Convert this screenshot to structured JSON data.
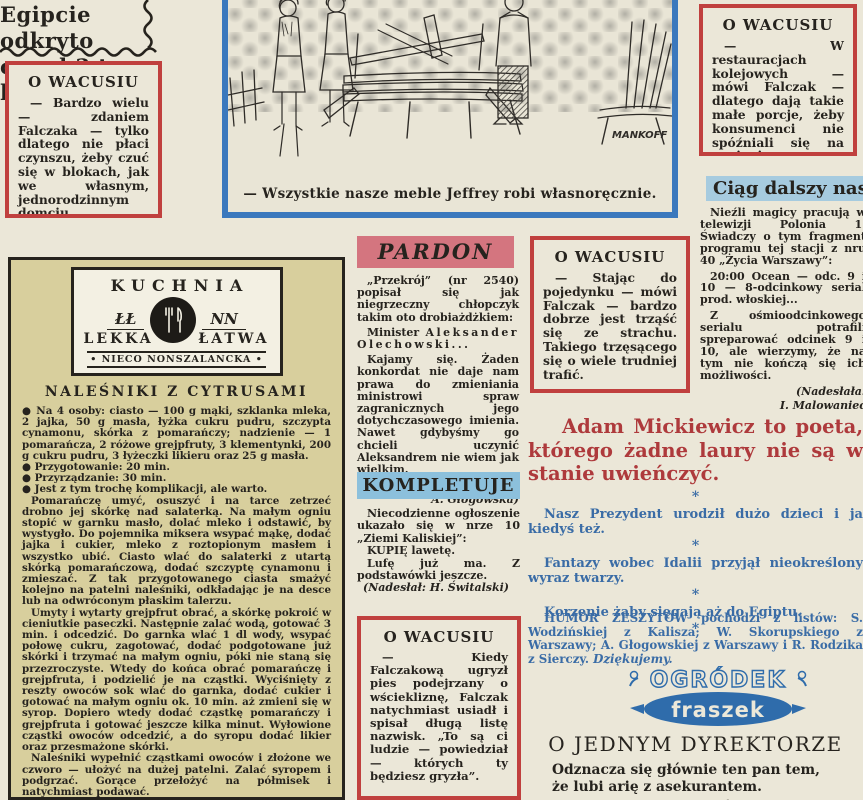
{
  "palette": {
    "paper": "#ebe7d8",
    "red_accent": "#c0403e",
    "red_heading": "#ae3a3c",
    "blue_border": "#3a78bd",
    "blue_strip": "#a6cbdf",
    "pink_strip": "#d4757f",
    "light_blue_strip": "#8cc0dc",
    "blue_text": "#3a6ca6",
    "yellow_box": "#d8cf9d",
    "logo_blue": "#2f6cab"
  },
  "egypt_headline": {
    "line1": "Egipcie odkryto",
    "line2": "orzed 3 tys. lat."
  },
  "wacus_boxes": [
    {
      "title": "O WACUSIU",
      "text": "— Bardzo wielu — zdaniem Falczaka — tylko dlatego nie płaci czynszu, żeby czuć się w blokach, jak we własnym, jednorodzinnym domciu."
    },
    {
      "title": "O WACUSIU",
      "text": "— W restauracjach kolejowych — mówi Falczak — dlatego dają takie małe porcje, żeby konsumenci nie spóźniali się na pociągi."
    },
    {
      "title": "O WACUSIU",
      "text": "— Stając do pojedynku — mówi Falczak — bardzo dobrze jest trząść się ze strachu. Takiego trzęsącego się o wiele trudniej trafić."
    },
    {
      "title": "O WACUSIU",
      "text": "— Kiedy Falczakową ugryzł pies podejrzany o wściekliznę, Falczak natychmiast usiadł i spisał długą listę nazwisk. „To są ci ludzie — powiedział — których ty będziesz gryzła”."
    }
  ],
  "cartoon": {
    "caption": "— Wszystkie nasze meble Jeffrey robi własnoręcznie.",
    "signature": "MANKOFF"
  },
  "ciag_dalszy": {
    "title": "Ciąg dalszy nastąpi",
    "para1": "Nieźli magicy pracują w telewizji Polonia 1. Świadczy o tym fragment programu tej stacji z nru 40 „Życia Warszawy”:",
    "para2": "20:00 Ocean — odc. 9 i 10 — 8-odcinkowy serial prod. włoskiej...",
    "para3": "Z ośmioodcinkowego serialu potrafili spreparować odcinek 9 i 10, ale wierzymy, że na tym nie kończą się ich możliwości.",
    "credit1": "(Nadesłała:",
    "credit2": "I. Malowaniec"
  },
  "kuchnia": {
    "logo": {
      "title": "KUCHNIA",
      "script_left": "ŁŁ",
      "script_right": "NN",
      "word_left": "LEKKA",
      "word_right": "ŁATWA",
      "subtitle": "• NIECO NONSZALANCKA •"
    },
    "heading": "NALEŚNIKI Z CYTRUSAMI",
    "bullet1": "● Na 4 osoby: ciasto — 100 g mąki, szklanka mleka, 2 jajka, 50 g masła, łyżka cukru pudru, szczypta cynamonu, skórka z pomarańczy; nadzienie — 1 pomarańcza, 2 różowe grejpfruty, 3 klementynki, 200 g cukru pudru, 3 łyżeczki likieru oraz 25 g masła.",
    "bullet2": "● Przygotowanie: 20 min.",
    "bullet3": "● Przyrządzanie: 30 min.",
    "bullet4": "● Jest z tym trochę komplikacji, ale warto.",
    "para1": "Pomarańczę umyć, osuszyć i na tarce zetrzeć drobno jej skórkę nad salaterką. Na małym ogniu stopić w garnku masło, dolać mleko i odstawić, by wystygło. Do pojemnika miksera wsypać mąkę, dodać jajka i cukier, mleko z roztopionym masłem i wszystko ubić. Ciasto wlać do salaterki z utartą skórką pomarańczową, dodać szczyptę cynamonu i zmieszać. Z tak przygotowanego ciasta smażyć kolejno na patelni naleśniki, odkładając je na desce lub na odwróconym płaskim talerzu.",
    "para2": "Umyty i wytarty grejpfrut obrać, a skórkę pokroić w cieniutkie paseczki. Następnie zalać wodą, gotować 3 min. i odcedzić. Do garnka wlać 1 dl wody, wsypać połowę cukru, zagotować, dodać podgotowane już skórki i trzymać na małym ogniu, póki nie staną się przezroczyste. Wtedy do końca obrać pomarańczę i grejpfruta, i podzielić je na cząstki. Wyciśnięty z reszty owoców sok wlać do garnka, dodać cukier i gotować na małym ogniu ok. 10 min. aż zmieni się w syrop. Dopiero wtedy dodać cząstkę pomarańczy i grejpfruta i gotować jeszcze kilka minut. Wyłowione cząstki owoców odcedzić, a do syropu dodać likier oraz przesmażone skórki.",
    "para3": "Naleśniki wypełnić cząstkami owoców i złożone we czworo — ułożyć na dużej patelni. Zalać syropem i podgrzać. Gorące przełożyć na półmisek i natychmiast podawać."
  },
  "pardon": {
    "title": "PARDON",
    "para1": "„Przekrój” (nr 2540) popisał się jak niegrzeczny chłopczyk takim oto drobiażdżkiem:",
    "minister_prefix": "Minister ",
    "minister": "Aleksander Olechowski...",
    "para3": "Kajamy się. Żaden konkordat nie daje nam prawa do zmieniania ministrowi spraw zagranicznych jego dotychczasowego imienia. Nawet gdybyśmy go chcieli uczynić Aleksandrem nie wiem jak wielkim.",
    "credit1": "(Nadesłała:",
    "credit2": "A. Głogowska)"
  },
  "kompletuje": {
    "title": "KOMPLETUJE",
    "para1": "Niecodzienne ogłoszenie ukazało się w nrze 10 „Ziemi Kaliskiej”:",
    "line_bold": "KUPIĘ lawetę.",
    "line2": "Lufę już ma. Z podstawówki jeszcze.",
    "credit": "(Nadesłał: H. Świtalski)"
  },
  "mickiewicz": {
    "heading": "Adam Mickiewicz to poeta, którego żadne laury nie są w stanie uwieńczyć.",
    "star": "*",
    "line1": "Nasz Prezydent urodził dużo dzieci i ja kiedyś też.",
    "line2": "Fantazy wobec Idalii przyjął nieokreślony wyraz twarzy.",
    "line3": "Korzenie żaby sięgają aż do Egiptu."
  },
  "humor_note": {
    "seg1": "HUMOR ZESZYTÓW pochodzi z listów: ",
    "name1": "S. Wodzińskiej",
    "seg2": " z Kalisza; ",
    "name2": "W. Skorupskiego",
    "seg3": " z Warszawy; ",
    "name3": "A. Głogowskiej",
    "seg4": " z Warszawy i ",
    "name4": "R. Rodzika",
    "seg5": " z Sierczy. ",
    "thanks": "Dziękujemy."
  },
  "ogrodek": {
    "line1": "OGRÓDEK",
    "line2": "fraszek"
  },
  "dyrektor": {
    "title": "O JEDNYM DYREKTORZE",
    "line1": "Odznacza się głównie ten pan tem,",
    "line2": "że lubi arię z asekurantem.",
    "author": "(Józef Prutkowski)"
  }
}
